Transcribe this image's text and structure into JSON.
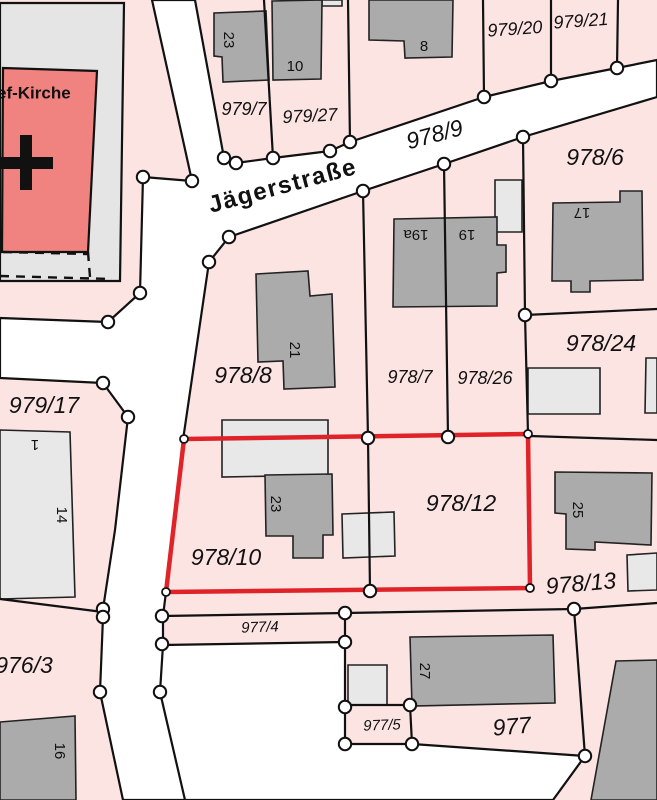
{
  "street": {
    "name": "Jägerstraße",
    "parcel_number": "978/9"
  },
  "church": {
    "label": "ef-Kirche"
  },
  "parcels": {
    "p979_7": "979/7",
    "p979_27": "979/27",
    "p979_20": "979/20",
    "p979_21": "979/21",
    "p978_6": "978/6",
    "p978_8": "978/8",
    "p978_7": "978/7",
    "p978_26": "978/26",
    "p978_24": "978/24",
    "p979_17": "979/17",
    "p978_10": "978/10",
    "p978_12": "978/12",
    "p978_13": "978/13",
    "p977_4": "977/4",
    "p976_3": "976/3",
    "p977": "977",
    "p977_5": "977/5"
  },
  "house_numbers": {
    "h23_top": "23",
    "h10": "10",
    "h8": "8",
    "h19a": "19a",
    "h19": "19",
    "h17": "17",
    "h21": "21",
    "h23": "23",
    "h25": "25",
    "h27": "27",
    "h1": "1",
    "h14": "14",
    "h16": "16"
  },
  "highlight": {
    "outlined_parcels": [
      "978/10",
      "978/12"
    ],
    "color": "#e02229"
  },
  "colors": {
    "parcel_fill": "#fce4e3",
    "road_fill": "#ffffff",
    "building_dark": "#ababab",
    "building_light": "#e8e8e8",
    "churchyard_fill": "#e5e5e5",
    "church_fill": "#f0837f",
    "boundary": "#111111",
    "highlight_red": "#e02229"
  }
}
